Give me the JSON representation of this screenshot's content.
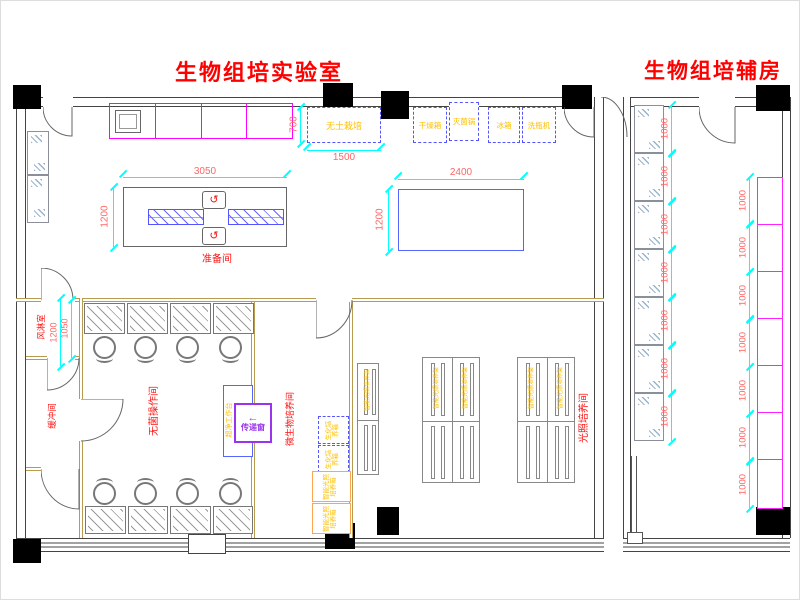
{
  "titles": {
    "lab": "生物组培实验室",
    "aux": "生物组培辅房"
  },
  "rooms": {
    "prep": "准备间",
    "air_shower": "风淋室",
    "buffer": "缓冲间",
    "sterile_op": "无菌操作间",
    "microbe": "微生物培养间",
    "light_culture": "光照培养间"
  },
  "equipment": {
    "soilless": "无土栽培",
    "dryer": "干燥箱",
    "sterilizer": "灭菌锅",
    "fridge": "冰箱",
    "bottle_washer": "洗瓶机",
    "pass_window": "传递窗",
    "clean_bench": "超净工作台",
    "bio_incubator": "生化培养箱",
    "light_incubator": "智能光照培养箱",
    "light_rack": "智能光照培养架"
  },
  "dims": {
    "d700": "700",
    "d1500": "1500",
    "d3050": "3050",
    "d1200": "1200",
    "d2400": "2400",
    "d1050": "1050",
    "d1000": "1000"
  },
  "icons": {
    "pass_arrow": "←",
    "faucet": "↺"
  },
  "colors": {
    "title_red": "#ff0000",
    "room_label_red": "#ff1111",
    "dim_text_pink": "#ff6666",
    "dim_line_cyan": "#00ffff",
    "equip_text_yellow": "#ffc000",
    "equip_blue": "#5555ff",
    "bench_magenta": "#ff00ff",
    "pass_purple": "#9933ee",
    "incubator_orange": "#ffa54f",
    "partition_tan": "#b89b4e",
    "line_gray": "#777777",
    "wall_black": "#000000"
  },
  "aux": {
    "left_shelf_cells": 7,
    "right_shelf_cells": 7,
    "cell_dim": "1000"
  },
  "sterile": {
    "bench_count": 4,
    "stool_count": 4
  },
  "light_room": {
    "rack_groups": 2,
    "rack_cols": 2,
    "rack_rows": 2
  }
}
